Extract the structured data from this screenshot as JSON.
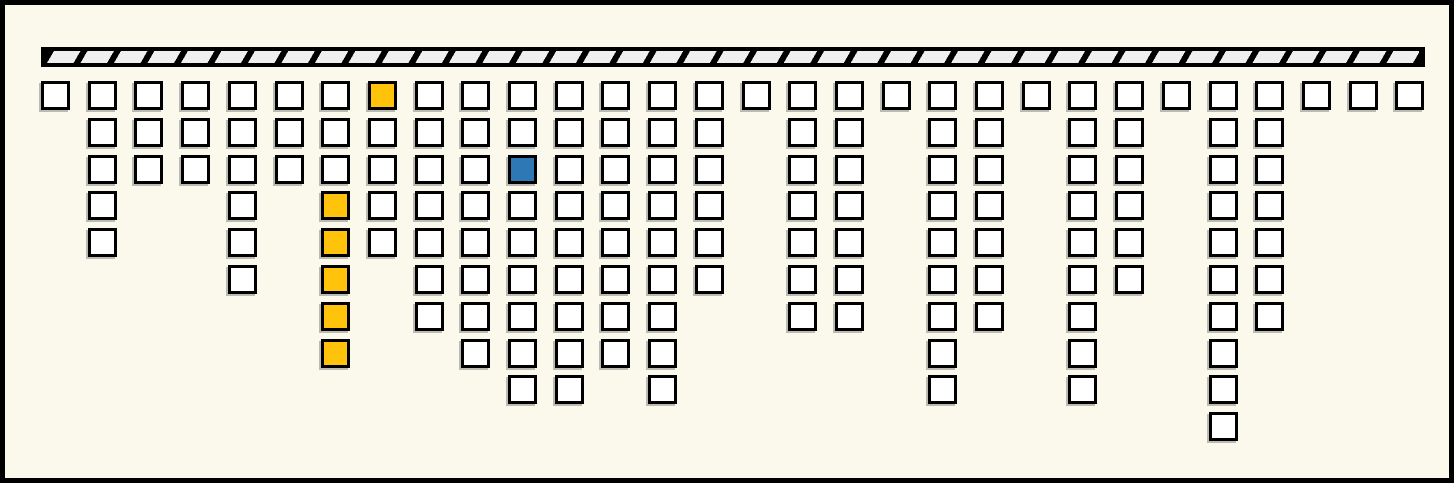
{
  "canvas": {
    "width": 1454,
    "height": 483,
    "background": "#FAF9EB",
    "frame_color": "#000000",
    "frame_thickness": 5
  },
  "support_bar": {
    "x": 36,
    "y": 42,
    "width": 1384,
    "height": 20,
    "fill": "#EFEFEF",
    "hatch_color": "#000000",
    "hatch_style": "diagonal-forward-slash",
    "border_color": "#000000"
  },
  "grid": {
    "origin_x": 36,
    "first_row_y": 76,
    "col_pitch": 46.7,
    "row_pitch": 36.8,
    "cell_size": 29,
    "cell_border": 3,
    "colors": {
      "cell_fill": "#FFFFFF",
      "cell_border": "#000000",
      "yellow": "#FFC30B",
      "blue": "#2E79B5",
      "shadow": "rgba(110,110,110,0.45)"
    },
    "columns": [
      {
        "col": 1,
        "count": 1,
        "highlights": []
      },
      {
        "col": 2,
        "count": 5,
        "highlights": []
      },
      {
        "col": 3,
        "count": 3,
        "highlights": []
      },
      {
        "col": 4,
        "count": 3,
        "highlights": []
      },
      {
        "col": 5,
        "count": 6,
        "highlights": []
      },
      {
        "col": 6,
        "count": 3,
        "highlights": []
      },
      {
        "col": 7,
        "count": 8,
        "highlights": [
          {
            "row": 4,
            "color": "yellow"
          },
          {
            "row": 5,
            "color": "yellow"
          },
          {
            "row": 6,
            "color": "yellow"
          },
          {
            "row": 7,
            "color": "yellow"
          },
          {
            "row": 8,
            "color": "yellow"
          }
        ]
      },
      {
        "col": 8,
        "count": 5,
        "highlights": [
          {
            "row": 1,
            "color": "yellow"
          }
        ]
      },
      {
        "col": 9,
        "count": 7,
        "highlights": []
      },
      {
        "col": 10,
        "count": 8,
        "highlights": []
      },
      {
        "col": 11,
        "count": 9,
        "highlights": [
          {
            "row": 3,
            "color": "blue"
          }
        ]
      },
      {
        "col": 12,
        "count": 9,
        "highlights": []
      },
      {
        "col": 13,
        "count": 8,
        "highlights": []
      },
      {
        "col": 14,
        "count": 9,
        "highlights": []
      },
      {
        "col": 15,
        "count": 6,
        "highlights": []
      },
      {
        "col": 16,
        "count": 1,
        "highlights": []
      },
      {
        "col": 17,
        "count": 7,
        "highlights": []
      },
      {
        "col": 18,
        "count": 7,
        "highlights": []
      },
      {
        "col": 19,
        "count": 1,
        "highlights": []
      },
      {
        "col": 20,
        "count": 9,
        "highlights": []
      },
      {
        "col": 21,
        "count": 7,
        "highlights": []
      },
      {
        "col": 22,
        "count": 1,
        "highlights": []
      },
      {
        "col": 23,
        "count": 9,
        "highlights": []
      },
      {
        "col": 24,
        "count": 6,
        "highlights": []
      },
      {
        "col": 25,
        "count": 1,
        "highlights": []
      },
      {
        "col": 26,
        "count": 10,
        "highlights": []
      },
      {
        "col": 27,
        "count": 7,
        "highlights": []
      },
      {
        "col": 28,
        "count": 1,
        "highlights": []
      },
      {
        "col": 29,
        "count": 1,
        "highlights": []
      },
      {
        "col": 30,
        "count": 1,
        "highlights": []
      }
    ]
  },
  "totals": {
    "columns": 30,
    "cells": 159,
    "yellow_cells": 6,
    "blue_cells": 1
  }
}
